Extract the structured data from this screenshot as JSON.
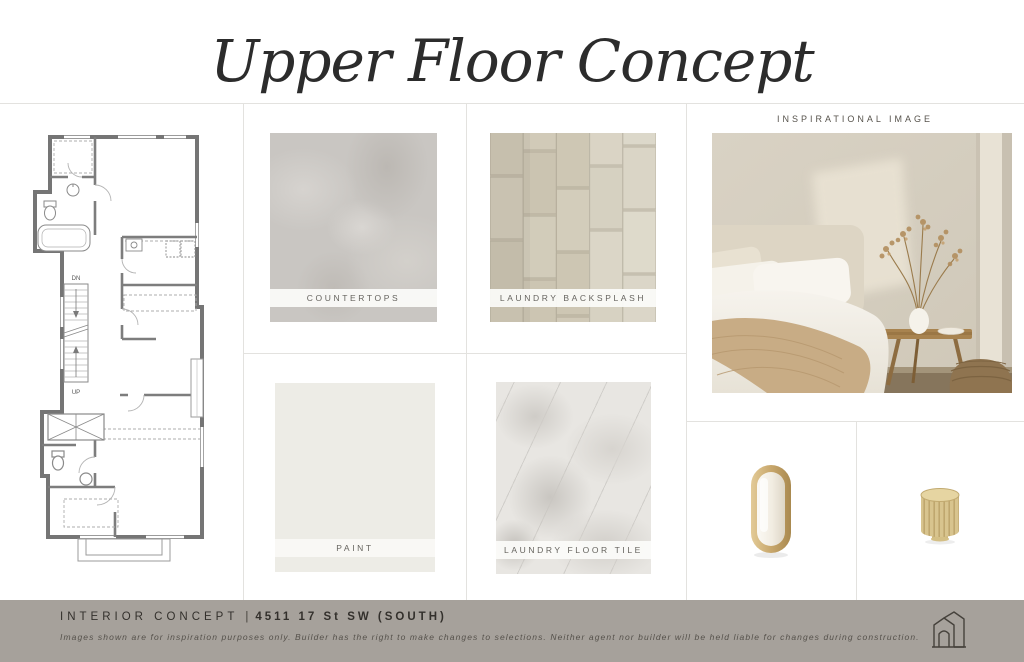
{
  "title": "Upper Floor Concept",
  "swatches": {
    "countertops": {
      "label": "COUNTERTOPS"
    },
    "laundry_backsplash": {
      "label": "LAUNDRY BACKSPLASH"
    },
    "paint": {
      "label": "PAINT"
    },
    "laundry_floor_tile": {
      "label": "LAUNDRY FLOOR TILE"
    }
  },
  "inspirational": {
    "label": "INSPIRATIONAL IMAGE"
  },
  "floor_plan": {
    "down_label": "DN",
    "up_label": "UP"
  },
  "footer": {
    "project_label": "INTERIOR CONCEPT",
    "separator": "|",
    "address": "4511 17 St SW (SOUTH)",
    "disclaimer": "Images shown are for inspiration purposes only. Builder has the right to make changes to selections. Neither agent nor builder will be held liable for changes during construction."
  },
  "colors": {
    "footer_bg": "#a6a19b",
    "brass": "#c8a76c",
    "countertop_gray": "#c9c6c2",
    "backsplash_beige": "#cdc6b3",
    "paint_white": "#edece6",
    "floor_tile_white": "#e8e6e2",
    "divider": "#e3e2df"
  }
}
